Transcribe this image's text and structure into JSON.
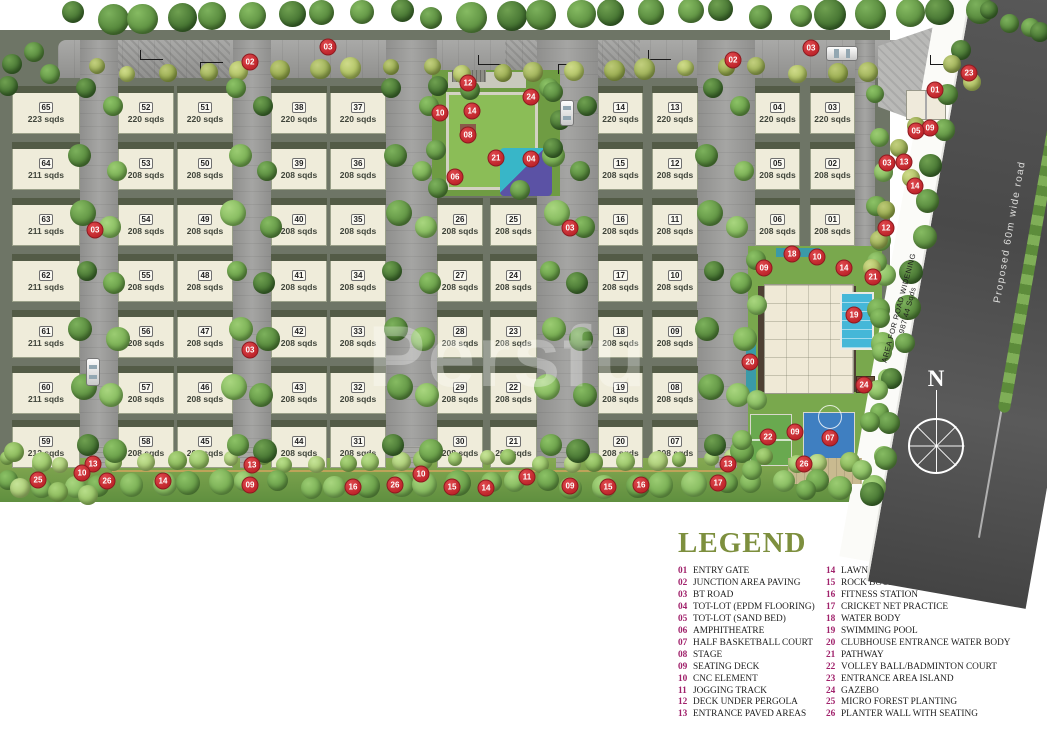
{
  "map": {
    "watermark": "Persfu",
    "compass": "N",
    "labels": {
      "proposed_road": "Proposed 60m wide road",
      "road_widening_1": "AREA FOR ROAD WIDENING",
      "road_widening_2": "987.44 Sqds"
    },
    "plots": [
      {
        "num": "65",
        "area": "223 sqds",
        "col": 0,
        "row": 0
      },
      {
        "num": "64",
        "area": "211 sqds",
        "col": 0,
        "row": 1
      },
      {
        "num": "63",
        "area": "211 sqds",
        "col": 0,
        "row": 2
      },
      {
        "num": "62",
        "area": "211 sqds",
        "col": 0,
        "row": 3
      },
      {
        "num": "61",
        "area": "211 sqds",
        "col": 0,
        "row": 4
      },
      {
        "num": "60",
        "area": "211 sqds",
        "col": 0,
        "row": 5
      },
      {
        "num": "59",
        "area": "212 sqds",
        "col": 0,
        "row": 6
      },
      {
        "num": "52",
        "area": "220 sqds",
        "col": 1,
        "row": 0
      },
      {
        "num": "53",
        "area": "208 sqds",
        "col": 1,
        "row": 1
      },
      {
        "num": "54",
        "area": "208 sqds",
        "col": 1,
        "row": 2
      },
      {
        "num": "55",
        "area": "208 sqds",
        "col": 1,
        "row": 3
      },
      {
        "num": "56",
        "area": "208 sqds",
        "col": 1,
        "row": 4
      },
      {
        "num": "57",
        "area": "208 sqds",
        "col": 1,
        "row": 5
      },
      {
        "num": "58",
        "area": "208 sqds",
        "col": 1,
        "row": 6
      },
      {
        "num": "51",
        "area": "220 sqds",
        "col": 2,
        "row": 0
      },
      {
        "num": "50",
        "area": "208 sqds",
        "col": 2,
        "row": 1
      },
      {
        "num": "49",
        "area": "208 sqds",
        "col": 2,
        "row": 2
      },
      {
        "num": "48",
        "area": "208 sqds",
        "col": 2,
        "row": 3
      },
      {
        "num": "47",
        "area": "208 sqds",
        "col": 2,
        "row": 4
      },
      {
        "num": "46",
        "area": "208 sqds",
        "col": 2,
        "row": 5
      },
      {
        "num": "45",
        "area": "208 sqds",
        "col": 2,
        "row": 6
      },
      {
        "num": "38",
        "area": "220 sqds",
        "col": 3,
        "row": 0
      },
      {
        "num": "39",
        "area": "208 sqds",
        "col": 3,
        "row": 1
      },
      {
        "num": "40",
        "area": "208 sqds",
        "col": 3,
        "row": 2
      },
      {
        "num": "41",
        "area": "208 sqds",
        "col": 3,
        "row": 3
      },
      {
        "num": "42",
        "area": "208 sqds",
        "col": 3,
        "row": 4
      },
      {
        "num": "43",
        "area": "208 sqds",
        "col": 3,
        "row": 5
      },
      {
        "num": "44",
        "area": "208 sqds",
        "col": 3,
        "row": 6
      },
      {
        "num": "37",
        "area": "220 sqds",
        "col": 4,
        "row": 0
      },
      {
        "num": "36",
        "area": "208 sqds",
        "col": 4,
        "row": 1
      },
      {
        "num": "35",
        "area": "208 sqds",
        "col": 4,
        "row": 2
      },
      {
        "num": "34",
        "area": "208 sqds",
        "col": 4,
        "row": 3
      },
      {
        "num": "33",
        "area": "208 sqds",
        "col": 4,
        "row": 4
      },
      {
        "num": "32",
        "area": "208 sqds",
        "col": 4,
        "row": 5
      },
      {
        "num": "31",
        "area": "208 sqds",
        "col": 4,
        "row": 6
      },
      {
        "num": "26",
        "area": "208 sqds",
        "col": 5,
        "row": 2
      },
      {
        "num": "27",
        "area": "208 sqds",
        "col": 5,
        "row": 3
      },
      {
        "num": "28",
        "area": "208 sqds",
        "col": 5,
        "row": 4
      },
      {
        "num": "29",
        "area": "208 sqds",
        "col": 5,
        "row": 5
      },
      {
        "num": "30",
        "area": "208 sqds",
        "col": 5,
        "row": 6
      },
      {
        "num": "25",
        "area": "208 sqds",
        "col": 6,
        "row": 2
      },
      {
        "num": "24",
        "area": "208 sqds",
        "col": 6,
        "row": 3
      },
      {
        "num": "23",
        "area": "208 sqds",
        "col": 6,
        "row": 4
      },
      {
        "num": "22",
        "area": "208 sqds",
        "col": 6,
        "row": 5
      },
      {
        "num": "21",
        "area": "208 sqds",
        "col": 6,
        "row": 6
      },
      {
        "num": "14",
        "area": "220 sqds",
        "col": 7,
        "row": 0
      },
      {
        "num": "15",
        "area": "208 sqds",
        "col": 7,
        "row": 1
      },
      {
        "num": "16",
        "area": "208 sqds",
        "col": 7,
        "row": 2
      },
      {
        "num": "17",
        "area": "208 sqds",
        "col": 7,
        "row": 3
      },
      {
        "num": "18",
        "area": "208 sqds",
        "col": 7,
        "row": 4
      },
      {
        "num": "19",
        "area": "208 sqds",
        "col": 7,
        "row": 5
      },
      {
        "num": "20",
        "area": "208 sqds",
        "col": 7,
        "row": 6
      },
      {
        "num": "13",
        "area": "220 sqds",
        "col": 8,
        "row": 0
      },
      {
        "num": "12",
        "area": "208 sqds",
        "col": 8,
        "row": 1
      },
      {
        "num": "11",
        "area": "208 sqds",
        "col": 8,
        "row": 2
      },
      {
        "num": "10",
        "area": "208 sqds",
        "col": 8,
        "row": 3
      },
      {
        "num": "09",
        "area": "208 sqds",
        "col": 8,
        "row": 4
      },
      {
        "num": "08",
        "area": "208 sqds",
        "col": 8,
        "row": 5
      },
      {
        "num": "07",
        "area": "208 sqds",
        "col": 8,
        "row": 6
      },
      {
        "num": "04",
        "area": "220 sqds",
        "col": 9,
        "row": 0
      },
      {
        "num": "05",
        "area": "208 sqds",
        "col": 9,
        "row": 1
      },
      {
        "num": "06",
        "area": "208 sqds",
        "col": 9,
        "row": 2
      },
      {
        "num": "03",
        "area": "220 sqds",
        "col": 10,
        "row": 0
      },
      {
        "num": "02",
        "area": "208 sqds",
        "col": 10,
        "row": 1
      },
      {
        "num": "01",
        "area": "208 sqds",
        "col": 10,
        "row": 2
      }
    ],
    "markers": [
      {
        "n": "02",
        "x": 250,
        "y": 62
      },
      {
        "n": "03",
        "x": 328,
        "y": 47
      },
      {
        "n": "02",
        "x": 733,
        "y": 60
      },
      {
        "n": "03",
        "x": 811,
        "y": 48
      },
      {
        "n": "01",
        "x": 935,
        "y": 90
      },
      {
        "n": "23",
        "x": 969,
        "y": 73
      },
      {
        "n": "09",
        "x": 930,
        "y": 128
      },
      {
        "n": "05",
        "x": 916,
        "y": 131
      },
      {
        "n": "03",
        "x": 887,
        "y": 163
      },
      {
        "n": "13",
        "x": 904,
        "y": 162
      },
      {
        "n": "14",
        "x": 915,
        "y": 186
      },
      {
        "n": "12",
        "x": 886,
        "y": 228
      },
      {
        "n": "21",
        "x": 873,
        "y": 277
      },
      {
        "n": "03",
        "x": 95,
        "y": 230
      },
      {
        "n": "03",
        "x": 250,
        "y": 350
      },
      {
        "n": "03",
        "x": 570,
        "y": 228
      },
      {
        "n": "12",
        "x": 468,
        "y": 83
      },
      {
        "n": "24",
        "x": 531,
        "y": 97
      },
      {
        "n": "10",
        "x": 440,
        "y": 113
      },
      {
        "n": "14",
        "x": 472,
        "y": 111
      },
      {
        "n": "08",
        "x": 468,
        "y": 135
      },
      {
        "n": "21",
        "x": 496,
        "y": 158
      },
      {
        "n": "04",
        "x": 531,
        "y": 159
      },
      {
        "n": "06",
        "x": 455,
        "y": 177
      },
      {
        "n": "18",
        "x": 792,
        "y": 254
      },
      {
        "n": "10",
        "x": 817,
        "y": 257
      },
      {
        "n": "09",
        "x": 764,
        "y": 268
      },
      {
        "n": "14",
        "x": 844,
        "y": 268
      },
      {
        "n": "19",
        "x": 854,
        "y": 315
      },
      {
        "n": "20",
        "x": 750,
        "y": 362
      },
      {
        "n": "24",
        "x": 864,
        "y": 385
      },
      {
        "n": "22",
        "x": 768,
        "y": 437
      },
      {
        "n": "09",
        "x": 795,
        "y": 432
      },
      {
        "n": "07",
        "x": 830,
        "y": 438
      },
      {
        "n": "26",
        "x": 804,
        "y": 464
      },
      {
        "n": "25",
        "x": 38,
        "y": 480
      },
      {
        "n": "13",
        "x": 93,
        "y": 464
      },
      {
        "n": "10",
        "x": 82,
        "y": 473
      },
      {
        "n": "26",
        "x": 107,
        "y": 481
      },
      {
        "n": "14",
        "x": 163,
        "y": 481
      },
      {
        "n": "13",
        "x": 252,
        "y": 465
      },
      {
        "n": "09",
        "x": 250,
        "y": 485
      },
      {
        "n": "16",
        "x": 353,
        "y": 487
      },
      {
        "n": "26",
        "x": 395,
        "y": 485
      },
      {
        "n": "10",
        "x": 421,
        "y": 474
      },
      {
        "n": "15",
        "x": 452,
        "y": 487
      },
      {
        "n": "14",
        "x": 486,
        "y": 488
      },
      {
        "n": "11",
        "x": 527,
        "y": 477
      },
      {
        "n": "09",
        "x": 570,
        "y": 486
      },
      {
        "n": "15",
        "x": 608,
        "y": 487
      },
      {
        "n": "16",
        "x": 641,
        "y": 485
      },
      {
        "n": "17",
        "x": 718,
        "y": 483
      },
      {
        "n": "13",
        "x": 728,
        "y": 464
      }
    ]
  },
  "legend": {
    "title": "LEGEND",
    "columns": [
      [
        {
          "num": "01",
          "label": "ENTRY GATE"
        },
        {
          "num": "02",
          "label": "JUNCTION AREA PAVING"
        },
        {
          "num": "03",
          "label": "BT ROAD"
        },
        {
          "num": "04",
          "label": "TOT-LOT (EPDM FLOORING)"
        },
        {
          "num": "05",
          "label": "TOT-LOT (SAND BED)"
        },
        {
          "num": "06",
          "label": "AMPHITHEATRE"
        },
        {
          "num": "07",
          "label": "HALF BASKETBALL COURT"
        },
        {
          "num": "08",
          "label": "STAGE"
        },
        {
          "num": "09",
          "label": "SEATING DECK"
        },
        {
          "num": "10",
          "label": "CNC ELEMENT"
        },
        {
          "num": "11",
          "label": "JOGGING TRACK"
        },
        {
          "num": "12",
          "label": "DECK UNDER PERGOLA"
        },
        {
          "num": "13",
          "label": "ENTRANCE PAVED AREAS"
        }
      ],
      [
        {
          "num": "14",
          "label": "LAWN"
        },
        {
          "num": "15",
          "label": "ROCK BOULDERS WITH PLANTING"
        },
        {
          "num": "16",
          "label": "FITNESS STATION"
        },
        {
          "num": "17",
          "label": "CRICKET NET PRACTICE"
        },
        {
          "num": "18",
          "label": "WATER BODY"
        },
        {
          "num": "19",
          "label": "SWIMMING POOL"
        },
        {
          "num": "20",
          "label": "CLUBHOUSE ENTRANCE WATER BODY"
        },
        {
          "num": "21",
          "label": "PATHWAY"
        },
        {
          "num": "22",
          "label": "VOLLEY BALL/BADMINTON COURT"
        },
        {
          "num": "23",
          "label": "ENTRANCE AREA ISLAND"
        },
        {
          "num": "24",
          "label": "GAZEBO"
        },
        {
          "num": "25",
          "label": "MICRO FOREST PLANTING"
        },
        {
          "num": "26",
          "label": "PLANTER WALL WITH SEATING"
        }
      ]
    ]
  },
  "colors": {
    "marker_red": "#c0262c",
    "legend_number": "#a0216b",
    "legend_title": "#7d8f3e",
    "plot_fill": "#efecda",
    "road_gray": "#9b9b99",
    "site_olive": "#6e7566",
    "pool_blue": "#45b7d8",
    "court_blue": "#3f7fc1",
    "court_green": "#69a94f"
  }
}
